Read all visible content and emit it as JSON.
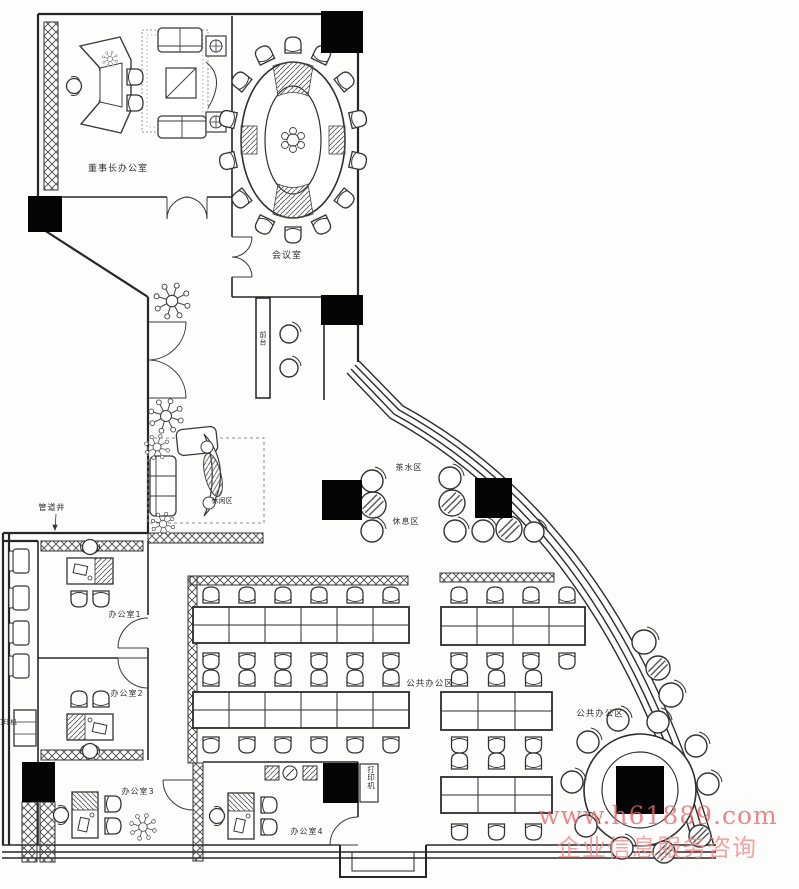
{
  "labels": {
    "chairman_office": "董事长办公室",
    "meeting_room": "会议室",
    "reception": "前台",
    "lounge": "休闲区",
    "tea_area": "茶水区",
    "rest_area": "休息区",
    "pipe_shaft": "管道井",
    "office1": "办公室1",
    "office2": "办公室2",
    "office3": "办公室3",
    "office4": "办公室4",
    "open_office_left": "公共办公区",
    "open_office_right": "公共办公区",
    "printer_left": "打印机",
    "printer_bottom": "打印机"
  },
  "watermark": {
    "line1": "www.h61889.com",
    "line2": "企业信息服务咨询",
    "color1": "#e3686b",
    "color2": "#ee8e8e"
  },
  "colors": {
    "wall": "#262626",
    "furniture": "#3a3a3a",
    "column": "#050505",
    "paper": "#fdfdfc"
  },
  "floorplan": {
    "desk_blocks": [
      {
        "x": 193,
        "y": 607,
        "cols": 6,
        "col_w": 36,
        "row_h": 18
      },
      {
        "x": 193,
        "y": 692,
        "cols": 6,
        "col_w": 36,
        "row_h": 18
      },
      {
        "x": 441,
        "y": 607,
        "cols": 4,
        "col_w": 36,
        "row_h": 19
      },
      {
        "x": 441,
        "y": 692,
        "cols": 3,
        "col_w": 37,
        "row_h": 19
      },
      {
        "x": 441,
        "y": 777,
        "cols": 3,
        "col_w": 37,
        "row_h": 18
      }
    ],
    "chair_rows": [
      {
        "x": 193,
        "y": 596,
        "count": 6,
        "spacing": 36,
        "flip": false
      },
      {
        "x": 193,
        "y": 660,
        "count": 6,
        "spacing": 36,
        "flip": true
      },
      {
        "x": 193,
        "y": 679,
        "count": 6,
        "spacing": 36,
        "flip": false
      },
      {
        "x": 193,
        "y": 744,
        "count": 6,
        "spacing": 36,
        "flip": true
      },
      {
        "x": 441,
        "y": 596,
        "count": 4,
        "spacing": 36,
        "flip": false
      },
      {
        "x": 441,
        "y": 660,
        "count": 4,
        "spacing": 36,
        "flip": true
      },
      {
        "x": 441,
        "y": 679,
        "count": 3,
        "spacing": 37,
        "flip": false
      },
      {
        "x": 441,
        "y": 744,
        "count": 3,
        "spacing": 37,
        "flip": true
      },
      {
        "x": 441,
        "y": 762,
        "count": 3,
        "spacing": 37,
        "flip": false
      },
      {
        "x": 441,
        "y": 831,
        "count": 3,
        "spacing": 37,
        "flip": true
      }
    ],
    "conference_table": {
      "cx": 293,
      "cy": 140,
      "rx": 52,
      "ry": 78,
      "chairs": 14,
      "chair_rx": 66,
      "chair_ry": 94
    },
    "round_table": {
      "cx": 640,
      "cy": 790,
      "r_outer": 56,
      "r_inner": 38
    },
    "round_chairs": [
      {
        "cx": 618,
        "cy": 720
      },
      {
        "cx": 658,
        "cy": 722
      },
      {
        "cx": 588,
        "cy": 742
      },
      {
        "cx": 696,
        "cy": 746
      },
      {
        "cx": 572,
        "cy": 782
      },
      {
        "cx": 708,
        "cy": 784
      },
      {
        "cx": 586,
        "cy": 826
      },
      {
        "cx": 622,
        "cy": 848
      },
      {
        "cx": 664,
        "cy": 852,
        "hatched": true
      },
      {
        "cx": 700,
        "cy": 836,
        "hatched": true
      }
    ],
    "arc_chairs": [
      {
        "cx": 644,
        "cy": 642
      },
      {
        "cx": 658,
        "cy": 668,
        "hatched": true
      },
      {
        "cx": 671,
        "cy": 695
      }
    ],
    "tea_circles": [
      {
        "cx": 372,
        "cy": 481,
        "r": 11
      },
      {
        "cx": 373,
        "cy": 505,
        "r": 13,
        "hatched": true
      },
      {
        "cx": 372,
        "cy": 531,
        "r": 11
      },
      {
        "cx": 450,
        "cy": 478,
        "r": 11
      },
      {
        "cx": 452,
        "cy": 503,
        "r": 13,
        "hatched": true
      },
      {
        "cx": 455,
        "cy": 531,
        "r": 11
      },
      {
        "cx": 483,
        "cy": 531,
        "r": 11
      },
      {
        "cx": 509,
        "cy": 529,
        "r": 13,
        "hatched": true
      },
      {
        "cx": 534,
        "cy": 532,
        "r": 10
      }
    ],
    "reception_stools": [
      {
        "cx": 289,
        "cy": 334,
        "r": 9
      },
      {
        "cx": 289,
        "cy": 368,
        "r": 9
      }
    ],
    "plants": [
      {
        "cx": 172,
        "cy": 301,
        "s": 1.15
      },
      {
        "cx": 166,
        "cy": 416,
        "s": 1.1
      },
      {
        "cx": 157,
        "cy": 447,
        "s": 0.8
      },
      {
        "cx": 163,
        "cy": 524,
        "s": 0.75
      },
      {
        "cx": 143,
        "cy": 827,
        "s": 0.85
      },
      {
        "cx": 110,
        "cy": 59,
        "s": 0.5
      }
    ],
    "columns": [
      {
        "x": 321,
        "y": 11,
        "w": 42,
        "h": 42
      },
      {
        "x": 28,
        "y": 196,
        "w": 34,
        "h": 36
      },
      {
        "x": 321,
        "y": 295,
        "w": 42,
        "h": 30
      },
      {
        "x": 322,
        "y": 480,
        "w": 40,
        "h": 40
      },
      {
        "x": 475,
        "y": 478,
        "w": 37,
        "h": 40
      },
      {
        "x": 22,
        "y": 762,
        "w": 33,
        "h": 40
      },
      {
        "x": 323,
        "y": 763,
        "w": 35,
        "h": 40
      },
      {
        "x": 616,
        "y": 766,
        "w": 48,
        "h": 48
      }
    ],
    "corridor_chairs": [
      {
        "x": 13,
        "y": 549
      },
      {
        "x": 13,
        "y": 586
      },
      {
        "x": 13,
        "y": 621
      },
      {
        "x": 13,
        "y": 654
      }
    ]
  }
}
